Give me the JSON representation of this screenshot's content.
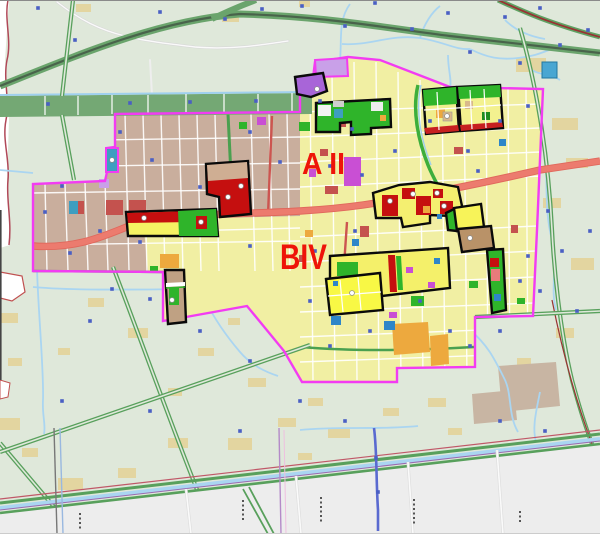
{
  "map": {
    "kind": "urban-planning-zoning-map",
    "zone_labels": [
      {
        "id": "AII",
        "text": "A II",
        "color": "#ee1409"
      },
      {
        "id": "BIV",
        "text": "BIV",
        "color": "#ee1409"
      }
    ],
    "palette": {
      "background_rural": "#dfe8da",
      "outside_map": "#ededed",
      "urban_tan": "#c9ae9d",
      "urban_yellow": "#f1efa3",
      "parcel_bright_yellow": "#f8f845",
      "parcel_red": "#c50f0f",
      "parcel_green": "#2fb42a",
      "parcel_orange": "#eda93e",
      "parcel_magenta": "#c94fd4",
      "parcel_violet": "#a865d8",
      "parcel_teal": "#3e9ec0",
      "road_salmon": "#ec7b6e",
      "road_green": "#58a05c",
      "band_green": "#74a874",
      "water_blue": "#aad5f1",
      "boundary_magenta": "#f23cf2",
      "parcel_outline_black": "#0a0a0a",
      "marker_blue": "#4a5fc4",
      "label_red": "#ee1409"
    },
    "bridge_markers": [
      [
        38,
        8
      ],
      [
        75,
        40
      ],
      [
        160,
        12
      ],
      [
        225,
        19
      ],
      [
        262,
        9
      ],
      [
        302,
        6
      ],
      [
        345,
        26
      ],
      [
        375,
        3
      ],
      [
        412,
        29
      ],
      [
        448,
        13
      ],
      [
        470,
        52
      ],
      [
        505,
        17
      ],
      [
        540,
        8
      ],
      [
        560,
        45
      ],
      [
        588,
        30
      ],
      [
        520,
        63
      ],
      [
        48,
        104
      ],
      [
        130,
        103
      ],
      [
        190,
        102
      ],
      [
        256,
        101
      ],
      [
        120,
        132
      ],
      [
        152,
        160
      ],
      [
        200,
        187
      ],
      [
        250,
        132
      ],
      [
        280,
        162
      ],
      [
        100,
        231
      ],
      [
        140,
        242
      ],
      [
        250,
        246
      ],
      [
        70,
        253
      ],
      [
        45,
        212
      ],
      [
        62,
        186
      ],
      [
        320,
        101
      ],
      [
        352,
        129
      ],
      [
        395,
        151
      ],
      [
        430,
        121
      ],
      [
        468,
        151
      ],
      [
        500,
        121
      ],
      [
        528,
        106
      ],
      [
        330,
        166
      ],
      [
        362,
        175
      ],
      [
        478,
        171
      ],
      [
        315,
        251
      ],
      [
        355,
        231
      ],
      [
        310,
        301
      ],
      [
        330,
        346
      ],
      [
        370,
        331
      ],
      [
        420,
        301
      ],
      [
        450,
        331
      ],
      [
        470,
        346
      ],
      [
        500,
        331
      ],
      [
        520,
        281
      ],
      [
        528,
        256
      ],
      [
        548,
        211
      ],
      [
        562,
        251
      ],
      [
        540,
        291
      ],
      [
        577,
        311
      ],
      [
        590,
        231
      ],
      [
        112,
        289
      ],
      [
        150,
        299
      ],
      [
        90,
        321
      ],
      [
        200,
        331
      ],
      [
        250,
        361
      ],
      [
        300,
        401
      ],
      [
        150,
        411
      ],
      [
        62,
        401
      ],
      [
        240,
        431
      ],
      [
        345,
        421
      ],
      [
        500,
        421
      ],
      [
        545,
        431
      ],
      [
        376,
        458
      ],
      [
        378,
        492
      ]
    ],
    "site_dots": [
      [
        228,
        197
      ],
      [
        241,
        186
      ],
      [
        144,
        218
      ],
      [
        201,
        222
      ],
      [
        390,
        201
      ],
      [
        413,
        194
      ],
      [
        444,
        206
      ],
      [
        437,
        193
      ],
      [
        447,
        116
      ],
      [
        172,
        300
      ],
      [
        470,
        238
      ],
      [
        317,
        89
      ],
      [
        112,
        160
      ],
      [
        352,
        293
      ]
    ],
    "dot_clusters": [
      {
        "x": 79,
        "y": 513,
        "count": 4
      },
      {
        "x": 242,
        "y": 500,
        "count": 5
      },
      {
        "x": 320,
        "y": 497,
        "count": 6
      },
      {
        "x": 413,
        "y": 499,
        "count": 6
      },
      {
        "x": 519,
        "y": 511,
        "count": 3
      }
    ]
  }
}
